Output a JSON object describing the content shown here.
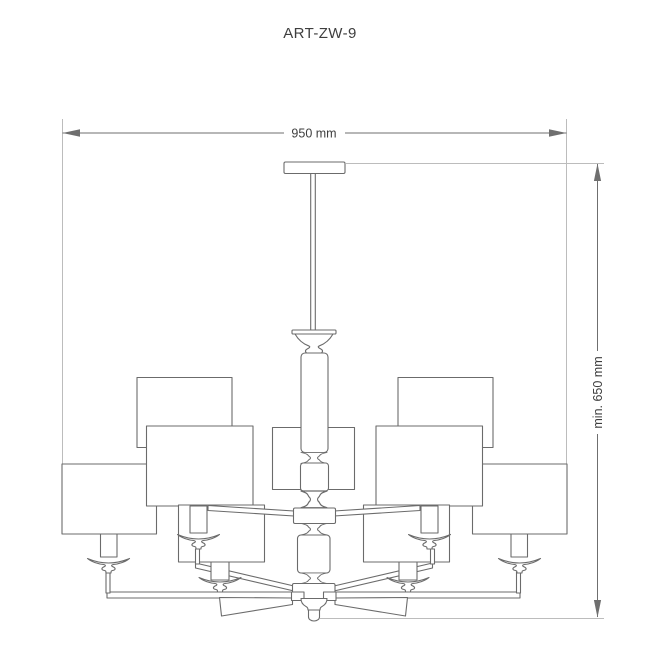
{
  "colors": {
    "bg": "#ffffff",
    "fill": "#ffffff",
    "line": "#6b6b6b",
    "dim": "#6f6f6f",
    "ext": "#bcbcbc",
    "text": "#3e3e3e"
  },
  "header": {
    "product_code": "ART-ZW-9"
  },
  "dimensions": {
    "width": {
      "label": "950 mm"
    },
    "height": {
      "label": "min. 650 mm"
    }
  }
}
